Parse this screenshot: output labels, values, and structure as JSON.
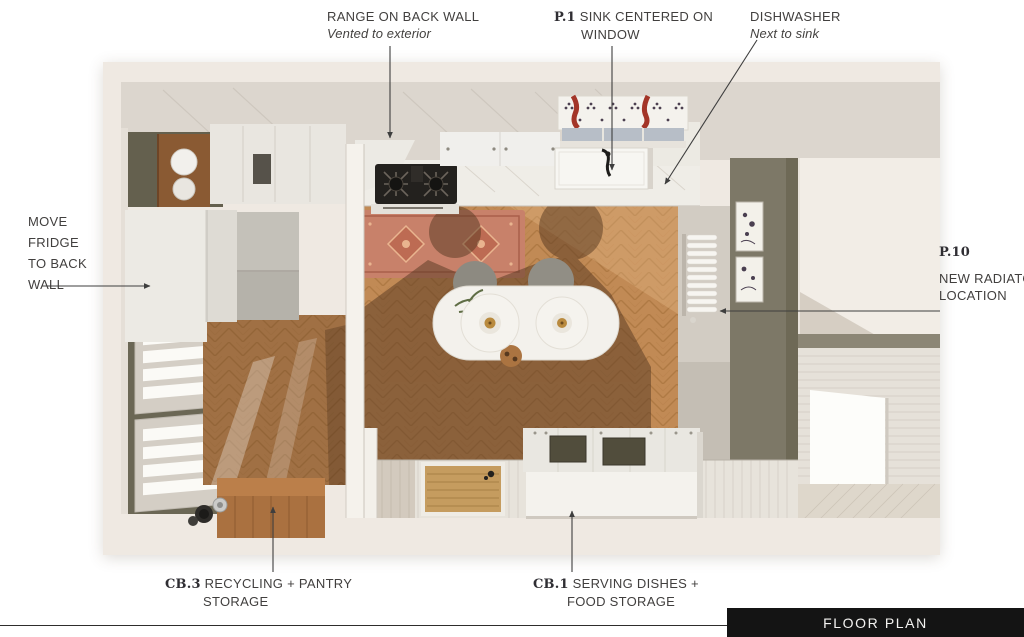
{
  "annotations": {
    "range": {
      "title": "RANGE ON BACK WALL",
      "note": "Vented to exterior"
    },
    "sink": {
      "code": "P.1",
      "label": "SINK CENTERED ON WINDOW"
    },
    "dishwasher": {
      "title": "DISHWASHER",
      "note": "Next to sink"
    },
    "fridge": {
      "label": "MOVE FRIDGE TO BACK WALL"
    },
    "radiator": {
      "code": "P.10",
      "label": "NEW RADIATOR LOCATION"
    },
    "cabinet_cb3": {
      "code": "CB.3",
      "label": "RECYCLING + PANTRY STORAGE"
    },
    "cabinet_cb1": {
      "code": "CB.1",
      "label": "SERVING DISHES + FOOD STORAGE"
    }
  },
  "footer": {
    "title": "FLOOR PLAN"
  },
  "colors": {
    "page_bg": "#ffffff",
    "card_bg": "#efe9e2",
    "wall_band": "#dcd6ce",
    "floor_wood": "#c18a55",
    "floor_shadow": "#563821",
    "rug_terracotta": "#c8816a",
    "pantry_olive": "#6b6755",
    "kitchen_olive_wall": "#7d7867",
    "footer_bar": "#141414",
    "label_text": "#413f3e"
  }
}
